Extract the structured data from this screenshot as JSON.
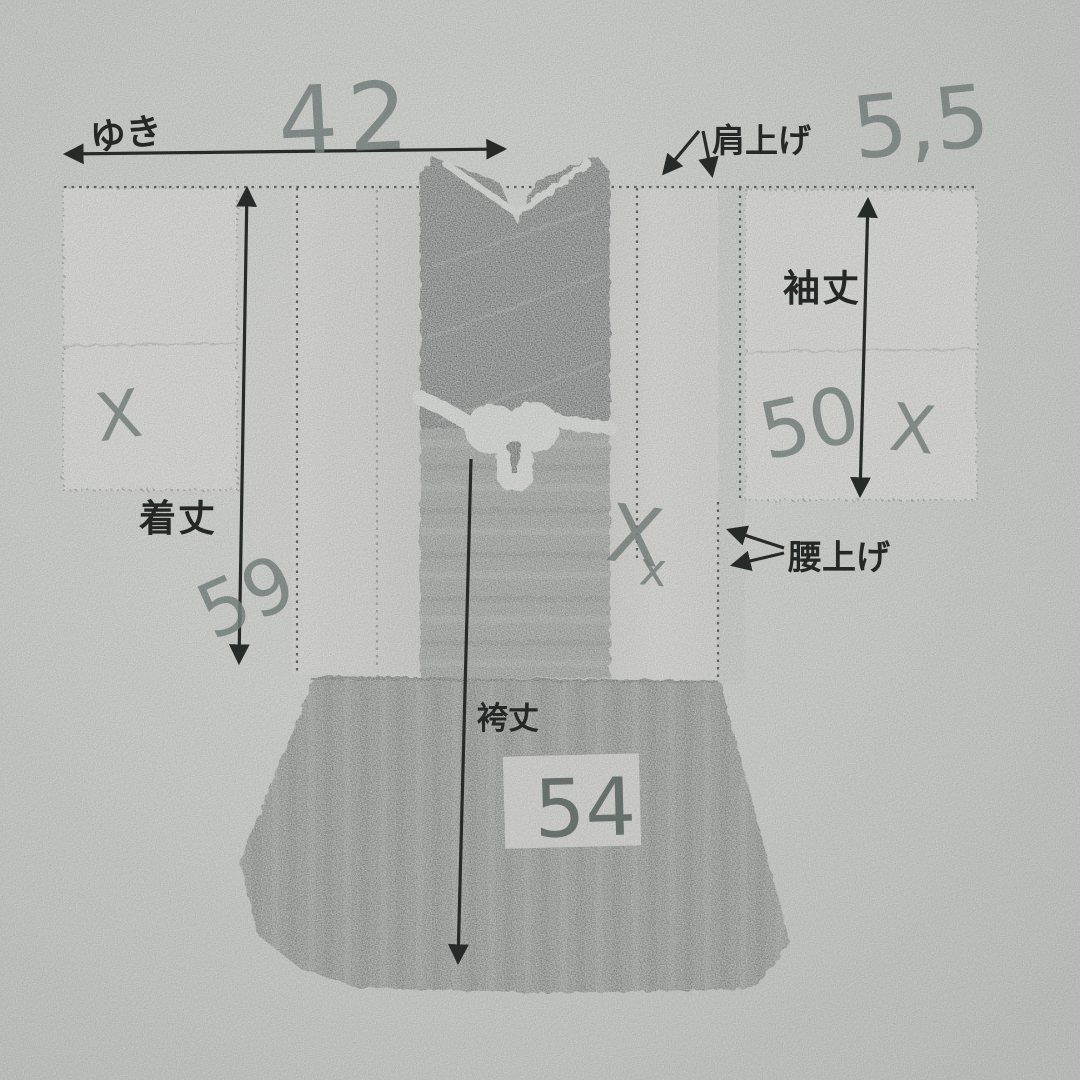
{
  "photo": {
    "description": "Hand-annotated print of a child's kimono and hakama with sewing measurements (cm)",
    "measurements": [
      {
        "id": "yuki",
        "label": "ゆき",
        "value": "42"
      },
      {
        "id": "kataage",
        "label": "肩上げ",
        "value": "5,5"
      },
      {
        "id": "sodetake",
        "label": "袖丈",
        "value": "50"
      },
      {
        "id": "kitake",
        "label": "着丈",
        "value": "59"
      },
      {
        "id": "koshiage",
        "label": "腰上げ",
        "value": ""
      },
      {
        "id": "hakamatake",
        "label": "袴丈",
        "value": "54"
      }
    ],
    "marks": {
      "sleeve_left": "X",
      "sleeve_right": "X",
      "body_large": "X",
      "body_small": "x"
    },
    "colors": {
      "paper": "#e9ebe7",
      "ink": "#2e3331",
      "pencil": "#8b9794",
      "dark_fabric": "#4d5957",
      "hakama_gray": "#7c837f"
    }
  }
}
